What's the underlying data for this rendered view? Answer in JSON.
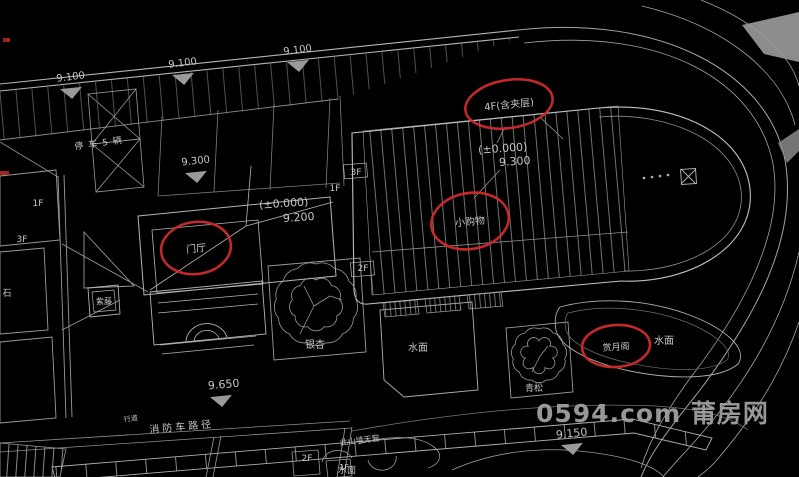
{
  "meta": {
    "description": "CAD site plan drawing, dark background",
    "background": "#000000"
  },
  "watermark": {
    "text": "0594.com 莆房网",
    "color": "#a4a4a4"
  },
  "colors": {
    "line_bright": "#c0c0c0",
    "line_mid": "#9a9a9a",
    "line_dim": "#6f6f6f",
    "text": "#c6c6c6",
    "red_annotation": "#cf2b2b",
    "marker_fill": "#9a9a9a",
    "gray_fill": "#9b9b9b"
  },
  "plan": {
    "labels": [
      {
        "name": "elevation-label",
        "text": "9.100",
        "x": 71,
        "y": 80,
        "size": 10,
        "rot": -7
      },
      {
        "name": "elevation-label",
        "text": "9.100",
        "x": 183,
        "y": 66,
        "size": 10,
        "rot": -7
      },
      {
        "name": "elevation-label",
        "text": "9.100",
        "x": 298,
        "y": 53,
        "size": 10,
        "rot": -7
      },
      {
        "name": "parking-note-label",
        "text": "停车5辆",
        "x": 101,
        "y": 146,
        "size": 9,
        "rot": -8,
        "ls": 5
      },
      {
        "name": "elevation-label",
        "text": "9.300",
        "x": 196,
        "y": 164,
        "size": 10,
        "rot": -6
      },
      {
        "name": "floor-label",
        "text": "1F",
        "x": 38,
        "y": 206,
        "size": 9
      },
      {
        "name": "floor-label",
        "text": "3F",
        "x": 22,
        "y": 242,
        "size": 9
      },
      {
        "name": "note-label",
        "text": "石",
        "x": 7,
        "y": 296,
        "size": 9
      },
      {
        "name": "floor-label",
        "text": "1F",
        "x": 335,
        "y": 191,
        "size": 9
      },
      {
        "name": "floor-label",
        "text": "3F",
        "x": 356,
        "y": 175,
        "size": 9
      },
      {
        "name": "datum-label",
        "text": "(±0.000)",
        "x": 284,
        "y": 207,
        "size": 11,
        "rot": -4
      },
      {
        "name": "elevation-label",
        "text": "9.200",
        "x": 299,
        "y": 221,
        "size": 11,
        "rot": -4
      },
      {
        "name": "datum-label",
        "text": "(±0.000)",
        "x": 503,
        "y": 152,
        "size": 11,
        "rot": -4
      },
      {
        "name": "elevation-label",
        "text": "9.300",
        "x": 515,
        "y": 165,
        "size": 11,
        "rot": -4
      },
      {
        "name": "floor-label",
        "text": "2F",
        "x": 363,
        "y": 271,
        "size": 9
      },
      {
        "name": "tree-label",
        "text": "银杏",
        "x": 315,
        "y": 348,
        "size": 10
      },
      {
        "name": "tree-label",
        "text": "青松",
        "x": 534,
        "y": 391,
        "size": 9
      },
      {
        "name": "tree-label",
        "text": "紫藤",
        "x": 104,
        "y": 304,
        "size": 8
      },
      {
        "name": "water-label",
        "text": "水面",
        "x": 418,
        "y": 351,
        "size": 10
      },
      {
        "name": "water-label",
        "text": "水面",
        "x": 664,
        "y": 344,
        "size": 10
      },
      {
        "name": "water-label",
        "text": "水面",
        "x": 347,
        "y": 473,
        "size": 9
      },
      {
        "name": "elevation-label",
        "text": "9.650",
        "x": 224,
        "y": 388,
        "size": 11,
        "rot": -5
      },
      {
        "name": "elevation-label",
        "text": "9.150",
        "x": 572,
        "y": 437,
        "size": 11,
        "rot": -6
      },
      {
        "name": "path-label",
        "text": "消防车路径",
        "x": 182,
        "y": 430,
        "size": 10,
        "rot": -5,
        "ls": 3
      },
      {
        "name": "note-label",
        "text": "此山墙无窗",
        "x": 360,
        "y": 443,
        "size": 8,
        "rot": -7
      },
      {
        "name": "note-label",
        "text": "行道",
        "x": 131,
        "y": 421,
        "size": 7,
        "rot": -7
      },
      {
        "name": "floor-label",
        "text": "2F",
        "x": 307,
        "y": 461,
        "size": 9
      },
      {
        "name": "floor-label",
        "text": "1F",
        "x": 344,
        "y": 470,
        "size": 8
      }
    ],
    "red_annotations": [
      {
        "name": "annotation-4f-mezzanine",
        "text": "4F(含夹层)",
        "cx": 509,
        "cy": 104,
        "rx": 44,
        "ry": 24,
        "rot": -9,
        "tsize": 10
      },
      {
        "name": "annotation-small-shop",
        "text": "小购物",
        "cx": 470,
        "cy": 221,
        "rx": 39,
        "ry": 28,
        "rot": -10,
        "tsize": 10
      },
      {
        "name": "annotation-entrance-hall",
        "text": "门厅",
        "cx": 196,
        "cy": 248,
        "rx": 35,
        "ry": 26,
        "rot": -8,
        "tsize": 10
      },
      {
        "name": "annotation-moon-pavilion",
        "text": "赏月阁",
        "cx": 616,
        "cy": 346,
        "rx": 34,
        "ry": 21,
        "rot": -4,
        "tsize": 9
      }
    ],
    "elevation_markers": [
      {
        "x": 71,
        "y": 88
      },
      {
        "x": 183,
        "y": 74
      },
      {
        "x": 298,
        "y": 61
      },
      {
        "x": 196,
        "y": 172
      },
      {
        "x": 221,
        "y": 396
      },
      {
        "x": 572,
        "y": 444
      }
    ]
  }
}
